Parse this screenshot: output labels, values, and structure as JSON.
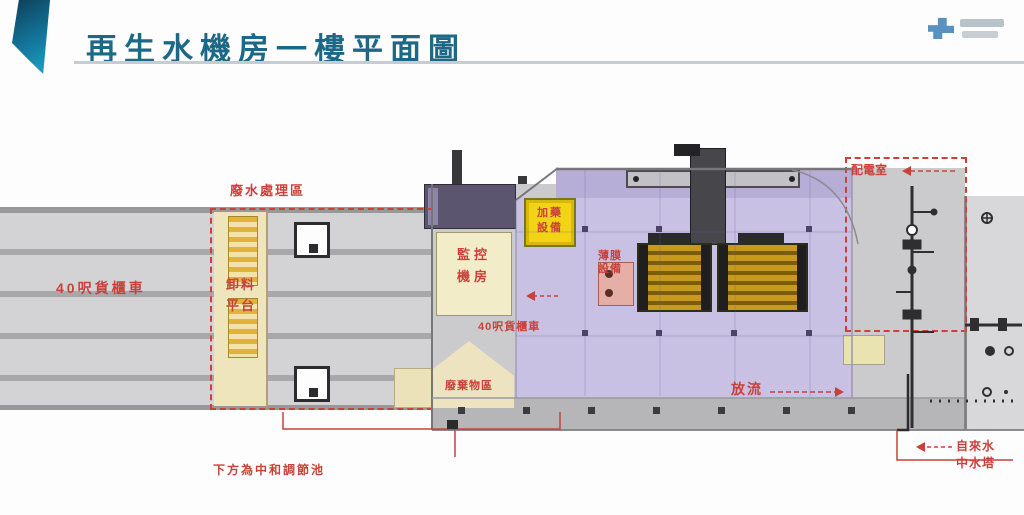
{
  "header": {
    "title": "再生水機房一樓平面圖"
  },
  "plan": {
    "treatment_area_label": "廢水處理區",
    "road_label": "40呎貨櫃車",
    "inner_road_label": "40呎貨櫃車",
    "unloading_room": {
      "line1": "卸料",
      "line2": "平台"
    },
    "control_room": {
      "line1": "監控",
      "line2": "機房"
    },
    "dosing_room": {
      "line1": "加藥",
      "line2": "設備"
    },
    "waste_room_label": "廢棄物區",
    "membrane_label": {
      "line1": "薄膜",
      "line2": "設備"
    },
    "power_room_label": "配電室",
    "discharge_label": "放流",
    "basement_label": "下方為中和調節池",
    "water_supply_label": "自來水",
    "reclaimed_tower_label": "中水塔"
  },
  "colors": {
    "annotation_red": "#c9413a",
    "title_teal": "#1d6886",
    "floor_purple": "#c8c1e3",
    "equipment_gold": "#c79a1e"
  }
}
